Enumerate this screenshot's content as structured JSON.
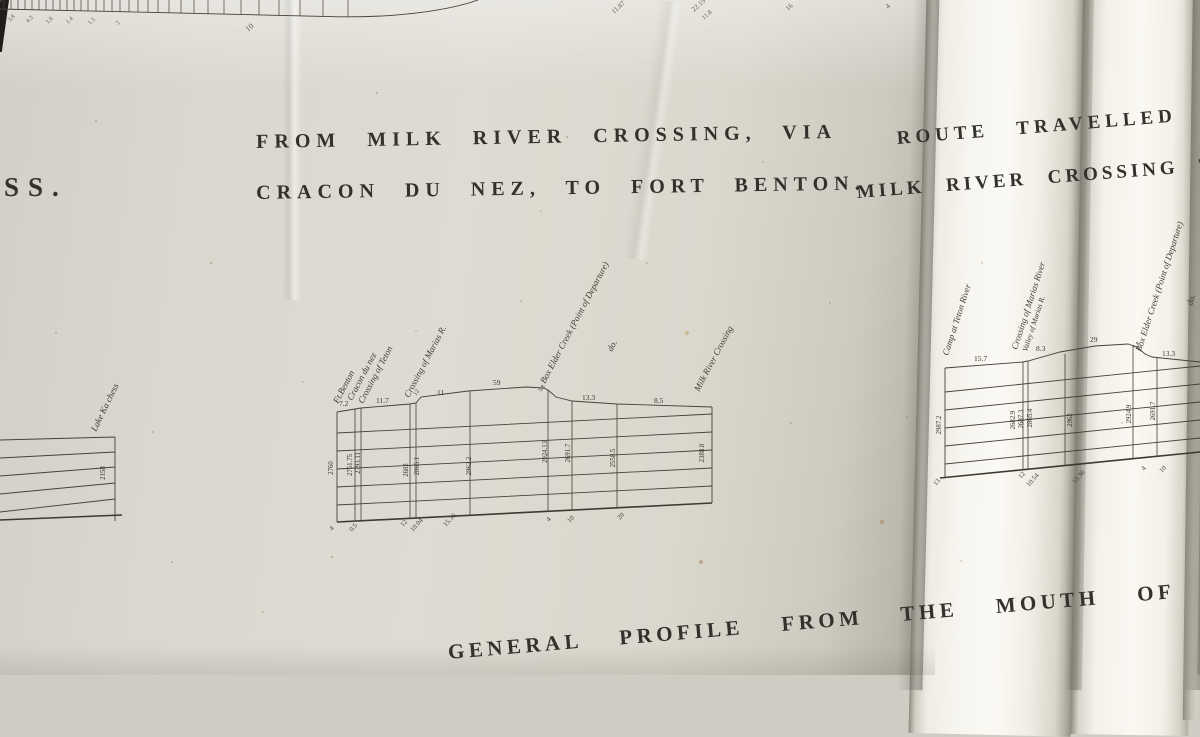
{
  "titles": {
    "left_partial": "SS.",
    "main_line1": "FROM MILK RIVER CROSSING, VIA",
    "main_line2": "CRACON DU NEZ, TO FORT BENTON.",
    "right_line1": "ROUTE TRAVELLED OVE",
    "right_line2": "MILK RIVER CROSSING TO",
    "bottom_partial": "GENERAL PROFILE FROM THE MOUTH OF"
  },
  "top_ruler": {
    "numbers": [
      "3.8",
      "4.3",
      "1.8",
      "1.4",
      "1.3",
      "2",
      "10",
      "11.87",
      "22.15",
      "11.8",
      "16",
      "4"
    ]
  },
  "main_profile": {
    "stations": [
      "Ft.Benton",
      "Cracon du nez",
      "Crossing of Teton",
      "Crossing of Marias R.",
      "Box Elder Creek (Point of Departure)",
      "do.",
      "Milk River Crossing"
    ],
    "distances": [
      "7.2",
      "11.7",
      "12",
      "11",
      "59",
      "5.8",
      "13.3",
      "8.5"
    ],
    "elevations": [
      "2760",
      "2751.75",
      "2793.11",
      "2682",
      "2865.1",
      "2962.2",
      "2924.13",
      "2691.7",
      "2558.5",
      "2388.8"
    ],
    "axis_marks": [
      "4",
      "0.5",
      "12",
      "10.04",
      "15.36",
      "4",
      "10",
      "20"
    ]
  },
  "left_profile": {
    "station": "Lake Ka chess",
    "elevation": "2158"
  },
  "right_profile": {
    "stations": [
      "Camp at Teton River",
      "Crossing of Marias River",
      "Valley of Marias R.",
      "Box Elder Creek (Point of Departure)",
      "do."
    ],
    "distances": [
      "15.7",
      "8.3",
      "29",
      "5.8",
      "13.3"
    ],
    "elevations": [
      "2987.2",
      "2682.9",
      "2687.3",
      "2865.4",
      "2962",
      "2924.9",
      "2691.7"
    ],
    "axis_marks": [
      "13",
      "12",
      "10.54",
      "13.36",
      "4",
      "10"
    ]
  },
  "chart_data": {
    "type": "line",
    "title": "FROM MILK RIVER CROSSING, VIA CRACON DU NEZ, TO FORT BENTON.",
    "xlabel": "distance between stations (miles)",
    "ylabel": "elevation (feet)",
    "segment_miles": [
      7.2,
      11.7,
      12,
      11,
      59,
      5.8,
      13.3,
      8.5
    ],
    "stations": [
      "Ft.Benton",
      "Cracon du nez / Crossing of Teton",
      "Crossing of Marias R.",
      "Box Elder Creek (Point of Departure)",
      "Milk River Crossing"
    ],
    "elevations_ft": [
      2760,
      2751.75,
      2793.11,
      2682,
      2865.1,
      2962.2,
      2924.13,
      2691.7,
      2558.5,
      2388.8
    ],
    "grid": "horizontal ruled lines"
  }
}
